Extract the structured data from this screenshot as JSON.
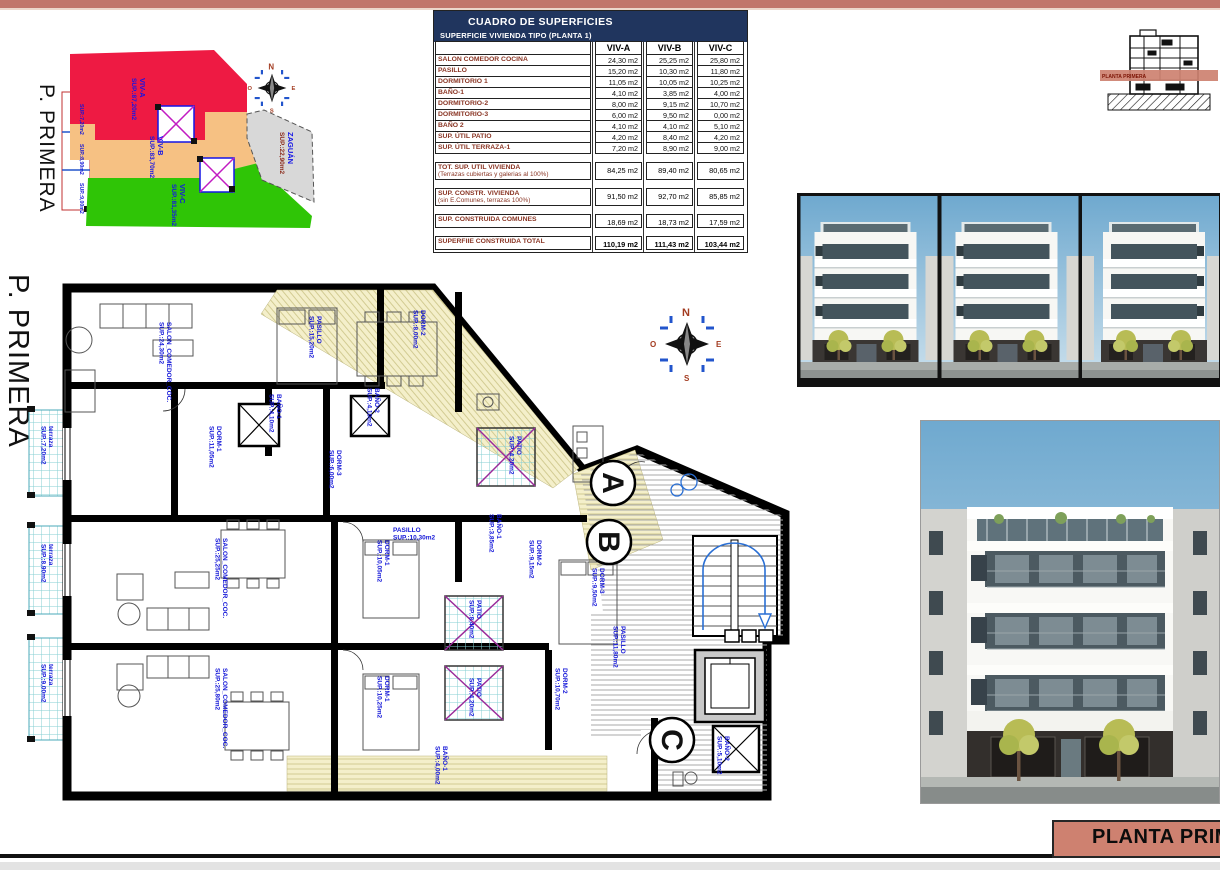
{
  "page": {
    "floor_label": "P. PRIMERA",
    "title_box": "PLANTA PRIMERA"
  },
  "section_thumb": {
    "band_label": "PLANTA PRIMERA"
  },
  "site_plan": {
    "zones": [
      {
        "name": "VIV-A",
        "area": "SUP.:87,20m2",
        "color": "#ee1a43"
      },
      {
        "name": "VIV-B",
        "area": "SUP.:83,70m2",
        "color": "#f6c183"
      },
      {
        "name": "VIV-C",
        "area": "SUP.:81,35m2",
        "color": "#2fc506"
      },
      {
        "name": "ZAGUÁN",
        "area": "SUP.:22,90m2",
        "color": "#d8d8d8"
      }
    ],
    "street_labels": [
      [
        "SUP.:7,20m2",
        80,
        84,
        90
      ],
      [
        "SUP.:8,90m2",
        80,
        124,
        90
      ],
      [
        "SUP.:9,00m2",
        80,
        163,
        90
      ]
    ],
    "compass": {
      "north": "N",
      "east": "E",
      "south": "S",
      "west": "O"
    }
  },
  "surface_table": {
    "title": "CUADRO DE SUPERFICIES",
    "subtitle": "SUPERFICIE VIVIENDA TIPO  (PLANTA 1)",
    "columns": [
      "VIV-A",
      "VIV-B",
      "VIV-C"
    ],
    "rows": [
      {
        "label": "SALON COMEDOR COCINA",
        "values": [
          "24,30 m2",
          "25,25 m2",
          "25,80 m2"
        ]
      },
      {
        "label": "PASILLO",
        "values": [
          "15,20 m2",
          "10,30 m2",
          "11,80 m2"
        ]
      },
      {
        "label": "DORMITORIO 1",
        "values": [
          "11,05 m2",
          "10,05 m2",
          "10,25 m2"
        ]
      },
      {
        "label": "BAÑO-1",
        "values": [
          "4,10 m2",
          "3,85 m2",
          "4,00 m2"
        ]
      },
      {
        "label": "DORMITORIO-2",
        "values": [
          "8,00 m2",
          "9,15 m2",
          "10,70 m2"
        ]
      },
      {
        "label": "DORMITORIO-3",
        "values": [
          "6,00 m2",
          "9,50 m2",
          "0,00 m2"
        ]
      },
      {
        "label": "BAÑO 2",
        "values": [
          "4,10 m2",
          "4,10 m2",
          "5,10 m2"
        ]
      },
      {
        "label": "SUP. ÚTIL PATIO",
        "values": [
          "4,20 m2",
          "8,40 m2",
          "4,20 m2"
        ]
      },
      {
        "label": "SUP. ÚTIL TERRAZA-1",
        "values": [
          "7,20 m2",
          "8,90 m2",
          "9,00 m2"
        ]
      }
    ],
    "summary_rows": [
      {
        "label": "TOT. SUP. UTIL VIVIENDA",
        "sublabel": "(Terrazas cubiertas y galerias al 100%)",
        "values": [
          "84,25 m2",
          "89,40 m2",
          "80,65 m2"
        ]
      },
      {
        "label": "SUP. CONSTR. VIVIENDA",
        "sublabel": "(sin E.Comunes, terrazas 100%)",
        "values": [
          "91,50 m2",
          "92,70 m2",
          "85,85 m2"
        ]
      },
      {
        "label": "SUP. CONSTRUIDA COMUNES",
        "sublabel": "",
        "values": [
          "18,69 m2",
          "18,73 m2",
          "17,59 m2"
        ]
      },
      {
        "label": "SUPERFIIE CONSTRUIDA TOTAL",
        "sublabel": "",
        "values": [
          "110,19 m2",
          "111,43 m2",
          "103,44 m2"
        ]
      }
    ]
  },
  "floor_plan": {
    "unit_markers": [
      "A",
      "B",
      "C"
    ],
    "compass": {
      "north": "N",
      "east": "E",
      "south": "S",
      "west": "O"
    },
    "rooms": [
      [
        "SALON_COMEDOR_COC.|SUP.:24,30m2",
        142,
        44,
        90
      ],
      [
        "DORM-1|SUP.:11,05m2",
        192,
        148,
        90
      ],
      [
        "BAÑO-1|SUP.:4,10m2",
        252,
        116,
        90
      ],
      [
        "BAÑO-2|SUP.:4,10m2",
        350,
        110,
        90
      ],
      [
        "DORM-3|SUP.:6,00m2",
        312,
        172,
        90
      ],
      [
        "PASILLO|SUP.:15,20m2",
        292,
        38,
        90
      ],
      [
        "DORM-2|SUP.:8,00m2",
        396,
        32,
        90
      ],
      [
        "terraza|SUP.:7,20m2",
        24,
        148,
        90
      ],
      [
        "PATIO|SUP.:4,20m2",
        492,
        158,
        90
      ],
      [
        "SALON_COMEDOR_COC.|SUP.:25,25m2",
        198,
        260,
        90
      ],
      [
        "DORM-1|SUP.:10,05m2",
        360,
        262,
        90
      ],
      [
        "DORM-2|SUP.:9,15m2",
        512,
        262,
        90
      ],
      [
        "DORM-3|SUP.:9,50m2",
        575,
        290,
        90
      ],
      [
        "BAÑO-1|SUP.:3,85m2",
        472,
        236,
        90
      ],
      [
        "PASILLO|SUP.:10,30m2",
        368,
        254,
        0
      ],
      [
        "terraza|SUP.:8,90m2",
        24,
        266,
        90
      ],
      [
        "terraza|SUP.:9,00m2",
        24,
        386,
        90
      ],
      [
        "PATIO|SUP.:8,40m2",
        452,
        322,
        90
      ],
      [
        "SALON_COMEDOR_COC.|SUP.:25,80m2",
        198,
        390,
        90
      ],
      [
        "DORM-1|SUP.:10,25m2",
        360,
        398,
        90
      ],
      [
        "DORM-2|SUP.:10,70m2",
        538,
        390,
        90
      ],
      [
        "PATIO|SUP.:4,20m2",
        452,
        400,
        90
      ],
      [
        "BAÑO-1|SUP.:4,00m2",
        418,
        468,
        90
      ],
      [
        "BAÑO-2|SUP.:5,10m2",
        700,
        458,
        90
      ],
      [
        "PASILLO|SUP.:11,80m2",
        596,
        348,
        90
      ]
    ]
  },
  "colors": {
    "accent_salmon": "#c1766b",
    "table_header_navy": "#20355e",
    "table_label_brown": "#8a3524",
    "zone_red": "#ee1a43",
    "zone_tan": "#f6c183",
    "zone_green": "#2fc506",
    "zone_gray": "#d8d8d8",
    "plan_label_blue": "#1316d8"
  }
}
